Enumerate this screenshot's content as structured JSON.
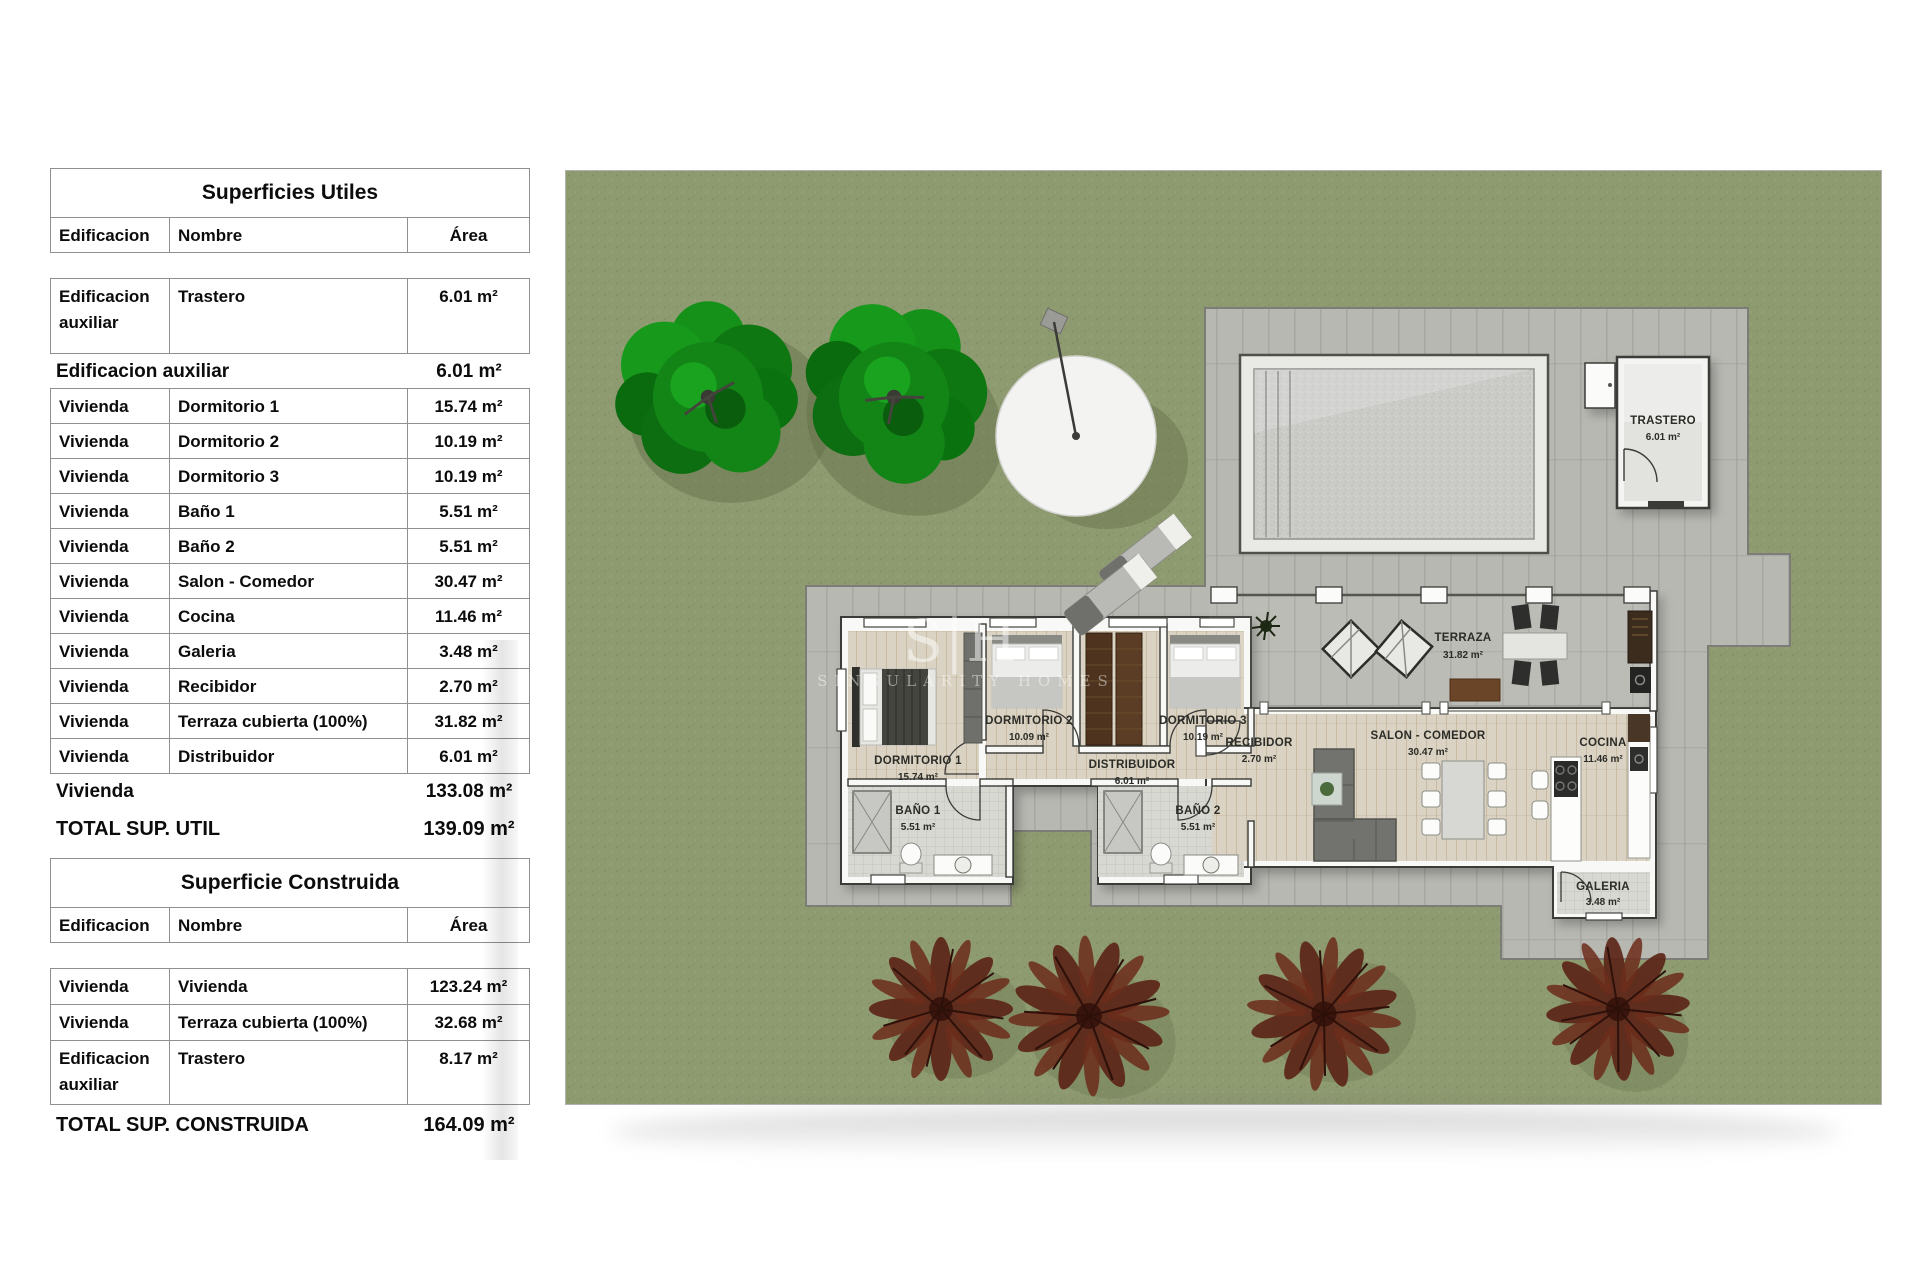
{
  "tables": {
    "utiles": {
      "title": "Superficies Utiles",
      "col_edificacion": "Edificacion",
      "col_nombre": "Nombre",
      "col_area": "Área",
      "aux_row": {
        "edificacion": "Edificacion auxiliar",
        "nombre": "Trastero",
        "area": "6.01 m²"
      },
      "aux_subtotal": {
        "label": "Edificacion auxiliar",
        "area": "6.01 m²"
      },
      "rows": [
        {
          "edificacion": "Vivienda",
          "nombre": "Dormitorio 1",
          "area": "15.74 m²"
        },
        {
          "edificacion": "Vivienda",
          "nombre": "Dormitorio 2",
          "area": "10.19 m²"
        },
        {
          "edificacion": "Vivienda",
          "nombre": "Dormitorio 3",
          "area": "10.19 m²"
        },
        {
          "edificacion": "Vivienda",
          "nombre": "Baño 1",
          "area": "5.51 m²"
        },
        {
          "edificacion": "Vivienda",
          "nombre": "Baño 2",
          "area": "5.51 m²"
        },
        {
          "edificacion": "Vivienda",
          "nombre": "Salon - Comedor",
          "area": "30.47 m²"
        },
        {
          "edificacion": "Vivienda",
          "nombre": "Cocina",
          "area": "11.46 m²"
        },
        {
          "edificacion": "Vivienda",
          "nombre": "Galeria",
          "area": "3.48 m²"
        },
        {
          "edificacion": "Vivienda",
          "nombre": "Recibidor",
          "area": "2.70 m²"
        },
        {
          "edificacion": "Vivienda",
          "nombre": "Terraza cubierta (100%)",
          "area": "31.82 m²"
        },
        {
          "edificacion": "Vivienda",
          "nombre": "Distribuidor",
          "area": "6.01 m²"
        }
      ],
      "viv_subtotal": {
        "label": "Vivienda",
        "area": "133.08 m²"
      },
      "total": {
        "label": "TOTAL SUP. UTIL",
        "area": "139.09 m²"
      }
    },
    "construida": {
      "title": "Superficie Construida",
      "col_edificacion": "Edificacion",
      "col_nombre": "Nombre",
      "col_area": "Área",
      "rows": [
        {
          "edificacion": "Vivienda",
          "nombre": "Vivienda",
          "area": "123.24 m²"
        },
        {
          "edificacion": "Vivienda",
          "nombre": "Terraza cubierta (100%)",
          "area": "32.68 m²"
        }
      ],
      "aux_row": {
        "edificacion": "Edificacion auxiliar",
        "nombre": "Trastero",
        "area": "8.17 m²"
      },
      "total": {
        "label": "TOTAL SUP. CONSTRUIDA",
        "area": "164.09 m²"
      }
    }
  },
  "plan": {
    "watermark": {
      "logo": "S|H",
      "name": "SINGULARITY HOMES"
    },
    "rooms": {
      "trastero": {
        "name": "TRASTERO",
        "area": "6.01 m²"
      },
      "terraza": {
        "name": "TERRAZA",
        "area": "31.82 m²"
      },
      "dormitorio1": {
        "name": "DORMITORIO 1",
        "area": "15.74 m²"
      },
      "dormitorio2": {
        "name": "DORMITORIO 2",
        "area": "10.09 m²"
      },
      "dormitorio3": {
        "name": "DORMITORIO 3",
        "area": "10.19 m²"
      },
      "distribuidor": {
        "name": "DISTRIBUIDOR",
        "area": "6.01 m²"
      },
      "recibidor": {
        "name": "RECIBIDOR",
        "area": "2.70 m²"
      },
      "bano1": {
        "name": "BAÑO 1",
        "area": "5.51 m²"
      },
      "bano2": {
        "name": "BAÑO 2",
        "area": "5.51 m²"
      },
      "salon": {
        "name": "SALON - COMEDOR",
        "area": "30.47 m²"
      },
      "cocina": {
        "name": "COCINA",
        "area": "11.46 m²"
      },
      "galeria": {
        "name": "GALERIA",
        "area": "3.48 m²"
      }
    },
    "colors": {
      "lawn": "#8e9a70",
      "paving": "#b8b8b3",
      "tree_green": "#128516",
      "tree_maroon": "#5c2316",
      "pool_water": "#cbcbc8",
      "wall": "#f8f8f6",
      "wood_floor": "#dad3c3"
    }
  }
}
